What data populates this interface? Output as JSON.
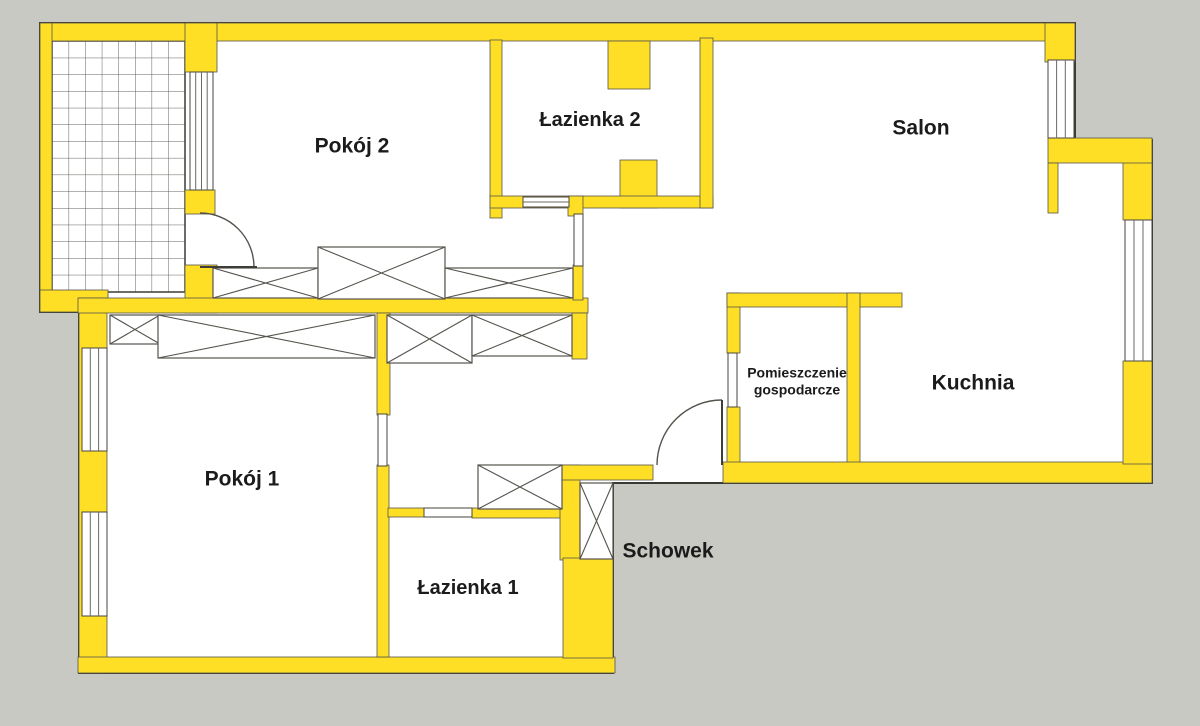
{
  "plan": {
    "background_color": "#C9C9C4",
    "wall_color": "#FFDF26",
    "floor_color": "#FFFFFF",
    "outline_color": "#3A3A35",
    "label_color": "#1B1B1B",
    "rooms": [
      {
        "id": "pokoj-2",
        "label": "Pokój 2",
        "label_x": 352,
        "label_y": 147,
        "font_size": 21
      },
      {
        "id": "lazienka-2",
        "label": "Łazienka 2",
        "label_x": 590,
        "label_y": 121,
        "font_size": 20
      },
      {
        "id": "salon",
        "label": "Salon",
        "label_x": 921,
        "label_y": 129,
        "font_size": 21
      },
      {
        "id": "pokoj-1",
        "label": "Pokój 1",
        "label_x": 242,
        "label_y": 480,
        "font_size": 21
      },
      {
        "id": "pomieszczenie-gospodarcze",
        "label": "Pomieszczenie\ngospodarcze",
        "label_x": 797,
        "label_y": 381,
        "font_size": 14
      },
      {
        "id": "kuchnia",
        "label": "Kuchnia",
        "label_x": 973,
        "label_y": 384,
        "font_size": 21
      },
      {
        "id": "lazienka-1",
        "label": "Łazienka 1",
        "label_x": 468,
        "label_y": 589,
        "font_size": 20
      },
      {
        "id": "schowek",
        "label": "Schowek",
        "label_x": 668,
        "label_y": 552,
        "font_size": 21
      }
    ]
  }
}
